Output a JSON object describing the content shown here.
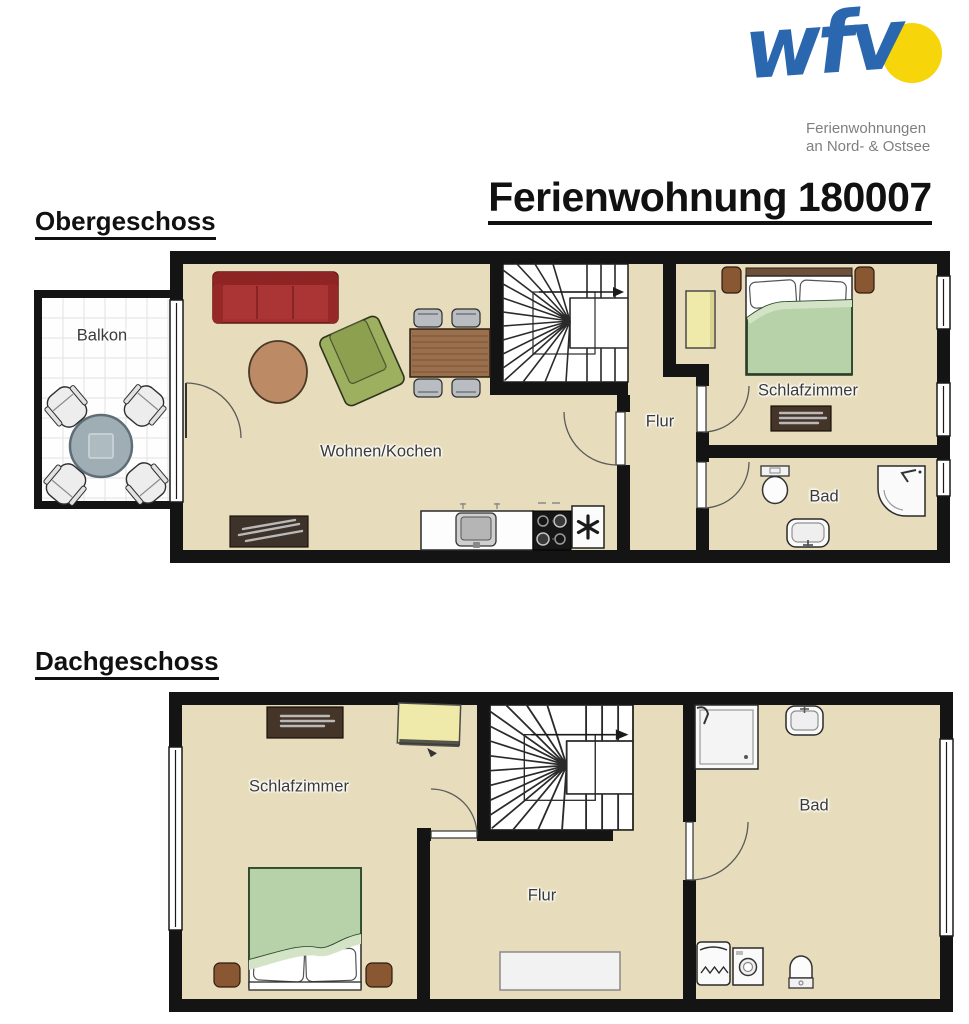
{
  "header": {
    "title": "Ferienwohnung 180007",
    "logo": {
      "brand": "wfv",
      "tagline_line1": "Ferienwohnungen",
      "tagline_line2": "an Nord- & Ostsee"
    }
  },
  "floors": {
    "obergeschoss": {
      "label": "Obergeschoss",
      "rooms": {
        "balkon": "Balkon",
        "wohnen_kochen": "Wohnen/Kochen",
        "flur": "Flur",
        "schlafzimmer": "Schlafzimmer",
        "bad": "Bad"
      }
    },
    "dachgeschoss": {
      "label": "Dachgeschoss",
      "rooms": {
        "schlafzimmer": "Schlafzimmer",
        "flur": "Flur",
        "bad": "Bad"
      }
    }
  },
  "icons": {
    "freezer_star": "✳",
    "stairs_direction_arrow": "→"
  },
  "colors": {
    "wall": "#141414",
    "floor": "#e7ddbc",
    "sofa_red": "#a63030",
    "armchair_green": "#9cb05f",
    "bed_blanket_green": "#b7d2a8",
    "wood_brown": "#996f4d",
    "coffee_table_brown": "#bd8a66",
    "dark_wood": "#443528",
    "wardrobe_yellow": "#efeaaa",
    "logo_blue": "#2b67ae",
    "logo_sun_yellow": "#f6d60a",
    "logo_gray": "#7f7f7f"
  }
}
